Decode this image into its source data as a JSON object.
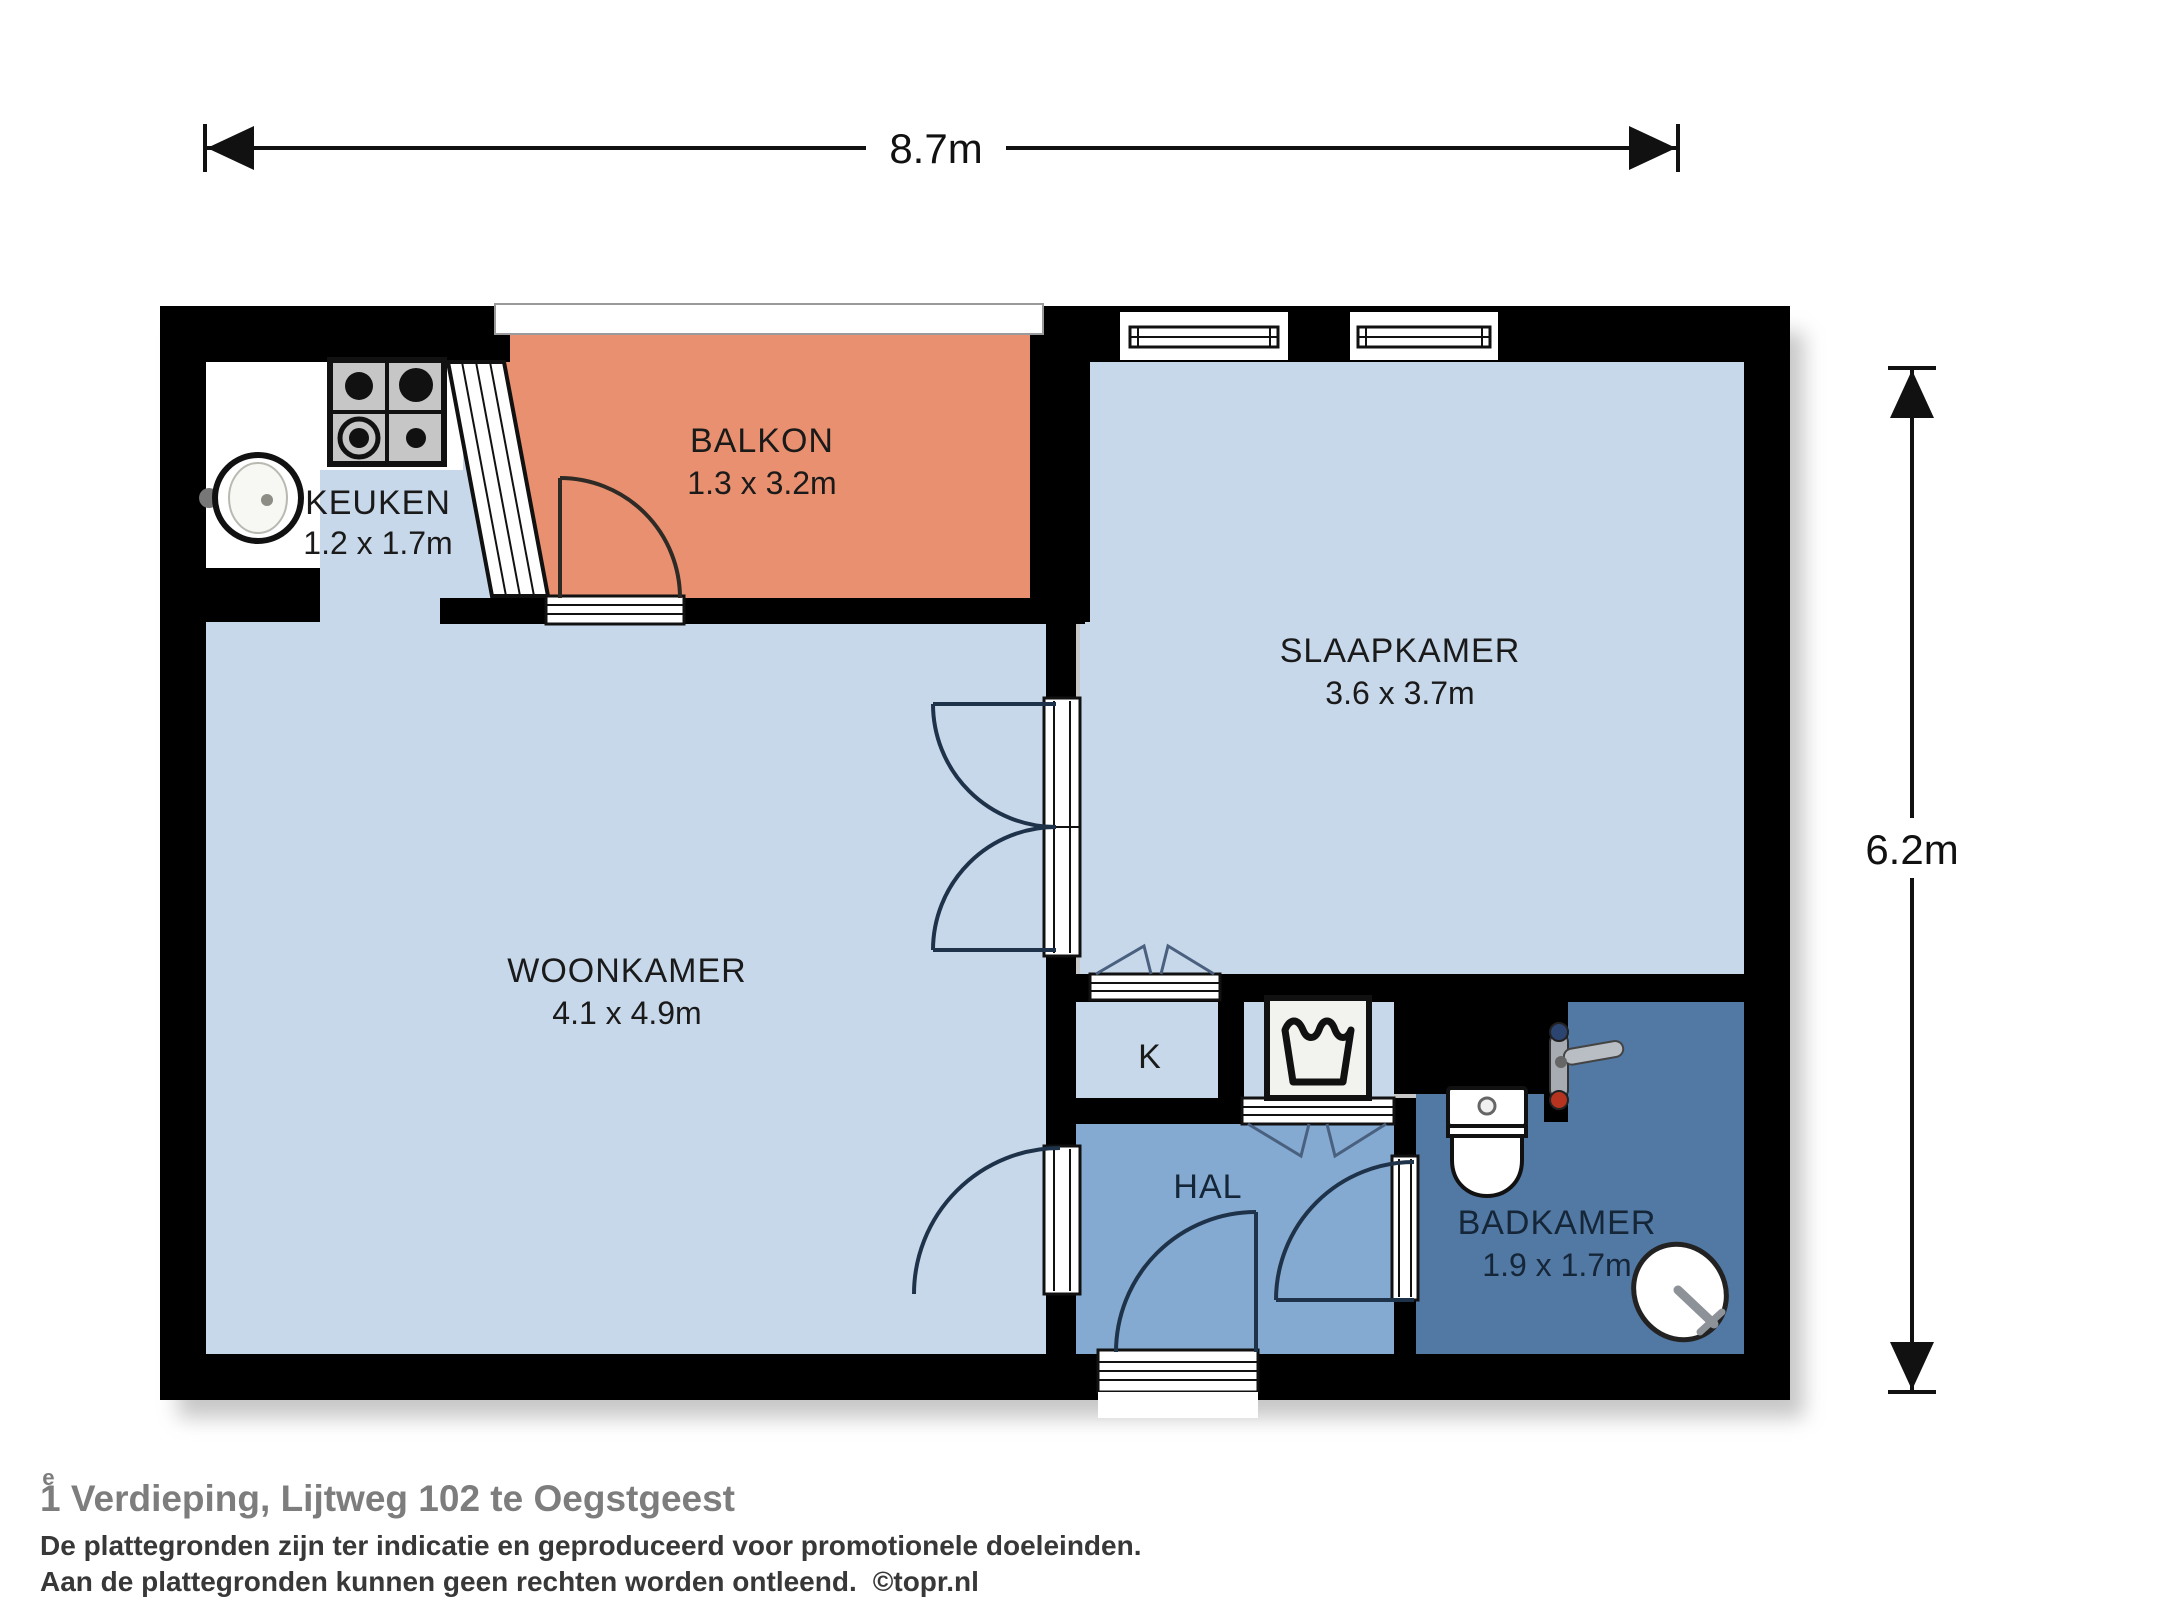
{
  "dimensions": {
    "width_label": "8.7m",
    "height_label": "6.2m"
  },
  "rooms": {
    "keuken": {
      "name": "KEUKEN",
      "size": "1.2 x 1.7m"
    },
    "balkon": {
      "name": "BALKON",
      "size": "1.3 x 3.2m"
    },
    "slaapkamer": {
      "name": "SLAAPKAMER",
      "size": "3.6 x 3.7m"
    },
    "woonkamer": {
      "name": "WOONKAMER",
      "size": "4.1 x 4.9m"
    },
    "kast": {
      "name": "K"
    },
    "hal": {
      "name": "HAL"
    },
    "badkamer": {
      "name": "BADKAMER",
      "size": "1.9 x 1.7m"
    }
  },
  "footer": {
    "title_number": "1",
    "title_superscript": "e",
    "title_rest": " Verdieping, Lijtweg 102 te Oegstgeest",
    "disclaimer_line1": "De plattegronden zijn ter indicatie en geproduceerd voor promotionele doeleinden.",
    "disclaimer_line2": "Aan de plattegronden kunnen geen rechten worden ontleend.",
    "credit": "©topr.nl"
  },
  "icons": {
    "stove": "gas-stove-icon",
    "sink": "round-sink-icon",
    "washing_machine": "washing-machine-icon",
    "toilet": "toilet-icon",
    "shower": "shower-mixer-icon",
    "basin": "corner-basin-icon"
  },
  "colors": {
    "wall": "#000000",
    "floor_light": "#c8d8eb",
    "floor_hal": "#85aad1",
    "floor_badkamer": "#5278a4",
    "floor_balkon": "#e8906f",
    "door_arc": "#1e3349",
    "label_dark": "#1a1a1a",
    "label_navy": "#142638",
    "dimension": "#111111",
    "title": "#7d7d7d",
    "disclaimer": "#383838"
  }
}
